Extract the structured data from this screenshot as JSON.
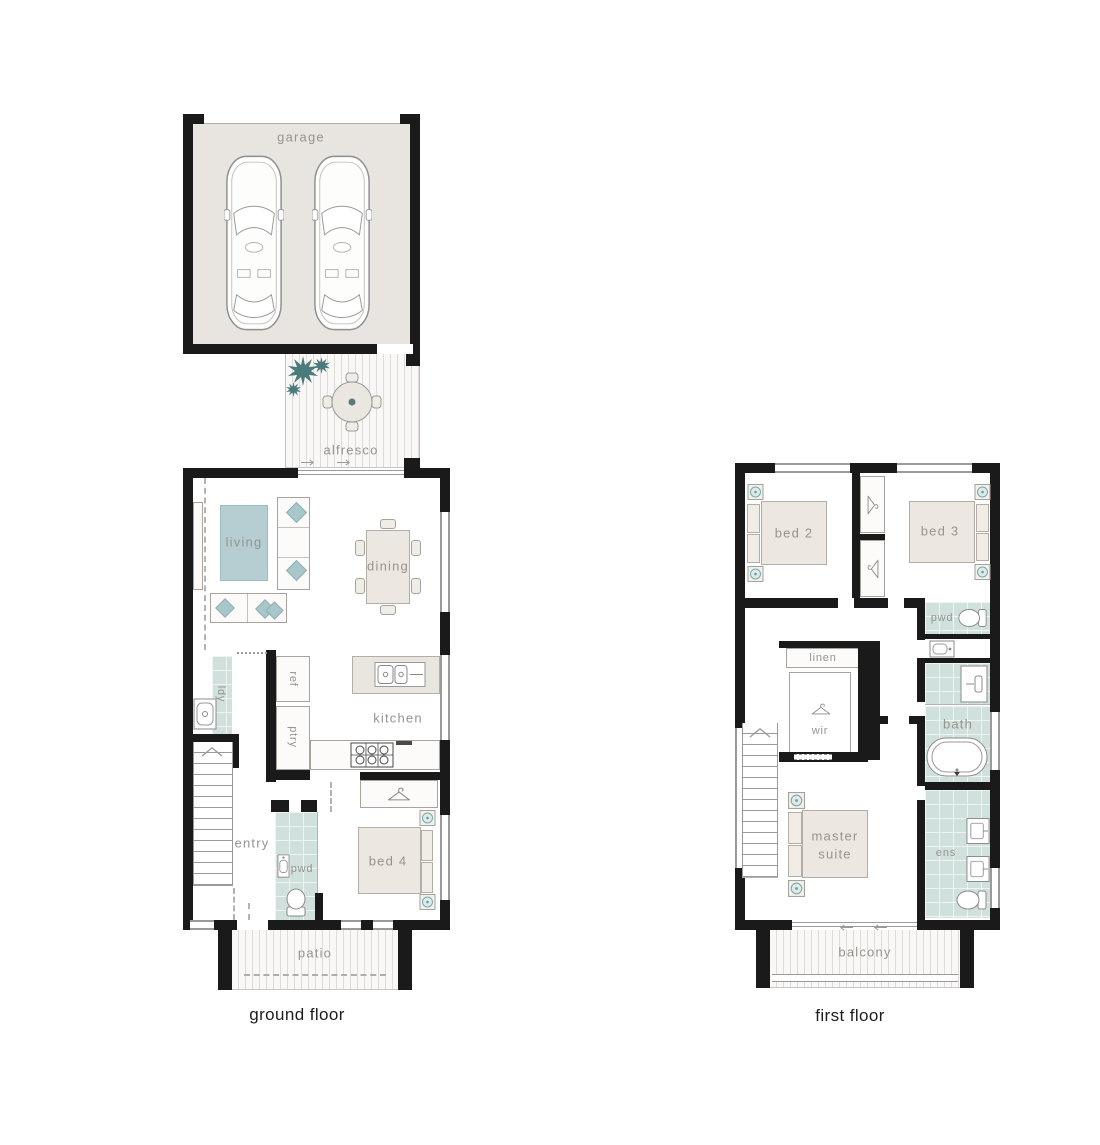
{
  "palette": {
    "wall": "#1a1a1a",
    "room_fill": "#ffffff",
    "garage_fill": "#e8e5e0",
    "furniture_fill": "#ece8e1",
    "accent_teal": "#a9c6ca",
    "wet_floor_teal": "#cfe0dd",
    "plant_teal": "#4b7a7a",
    "label_grey": "#97938d"
  },
  "ground_floor": {
    "floor_label": "ground floor",
    "rooms": {
      "garage": "garage",
      "alfresco": "alfresco",
      "living": "living",
      "dining": "dining",
      "kitchen": "kitchen",
      "laundry": "ldy",
      "fridge": "ref",
      "pantry": "ptry",
      "entry": "entry",
      "powder": "pwd",
      "bed4": "bed 4",
      "patio": "patio"
    }
  },
  "first_floor": {
    "floor_label": "first floor",
    "rooms": {
      "bed2": "bed 2",
      "bed3": "bed 3",
      "powder": "pwd",
      "linen": "linen",
      "wardrobe": "wir",
      "bath": "bath",
      "master": "master suite",
      "ensuite": "ens",
      "balcony": "balcony"
    }
  }
}
